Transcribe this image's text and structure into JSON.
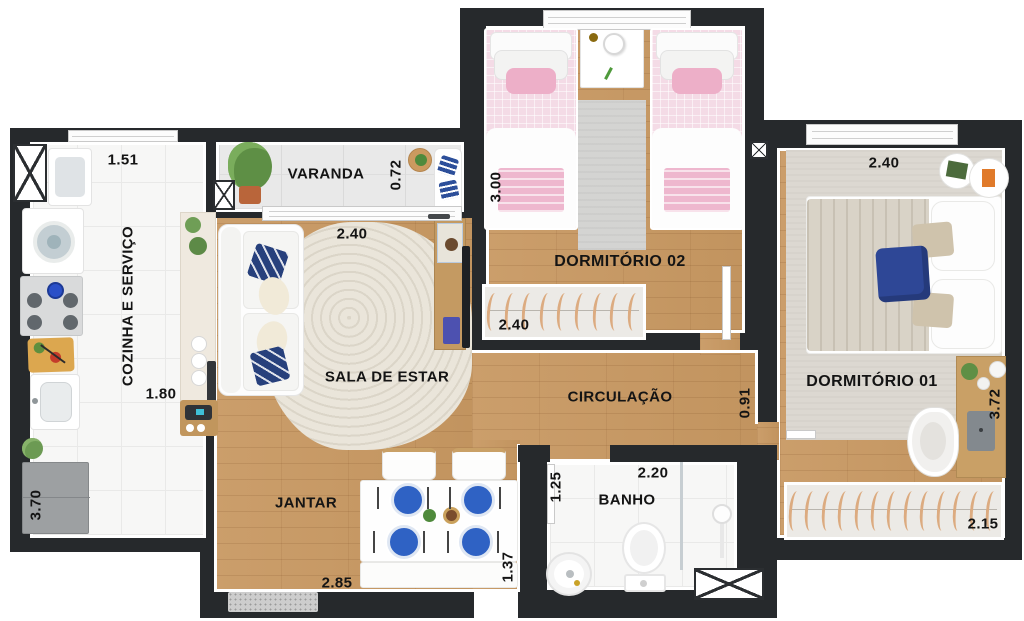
{
  "floorplan": {
    "rooms": {
      "cozinha": {
        "label": "COZINHA E SERVIÇO"
      },
      "varanda": {
        "label": "VARANDA"
      },
      "sala": {
        "label": "SALA DE ESTAR"
      },
      "jantar": {
        "label": "JANTAR"
      },
      "dormitorio02": {
        "label": "DORMITÓRIO 02"
      },
      "circulacao": {
        "label": "CIRCULAÇÃO"
      },
      "dormitorio01": {
        "label": "DORMITÓRIO 01"
      },
      "banho": {
        "label": "BANHO"
      }
    },
    "dims": {
      "cozinha_top": "1.51",
      "cozinha_mid": "1.80",
      "cozinha_left": "3.70",
      "varanda_depth": "0.72",
      "sala_window": "2.40",
      "jantar_width": "2.85",
      "jantar_depth": "1.37",
      "dorm02_left": "3.00",
      "dorm02_wardrobe": "2.40",
      "circulacao_width": "0.91",
      "dorm01_top": "2.40",
      "dorm01_right": "3.72",
      "dorm01_wardrobe": "2.15",
      "banho_left": "1.25",
      "banho_top": "2.20"
    },
    "colors": {
      "wall": "#26292c",
      "wood_floor": "#c79a67",
      "tile_floor": "#f7f7f6",
      "accent_blue": "#2f4b9e",
      "accent_pink": "#f2c9d8"
    }
  }
}
